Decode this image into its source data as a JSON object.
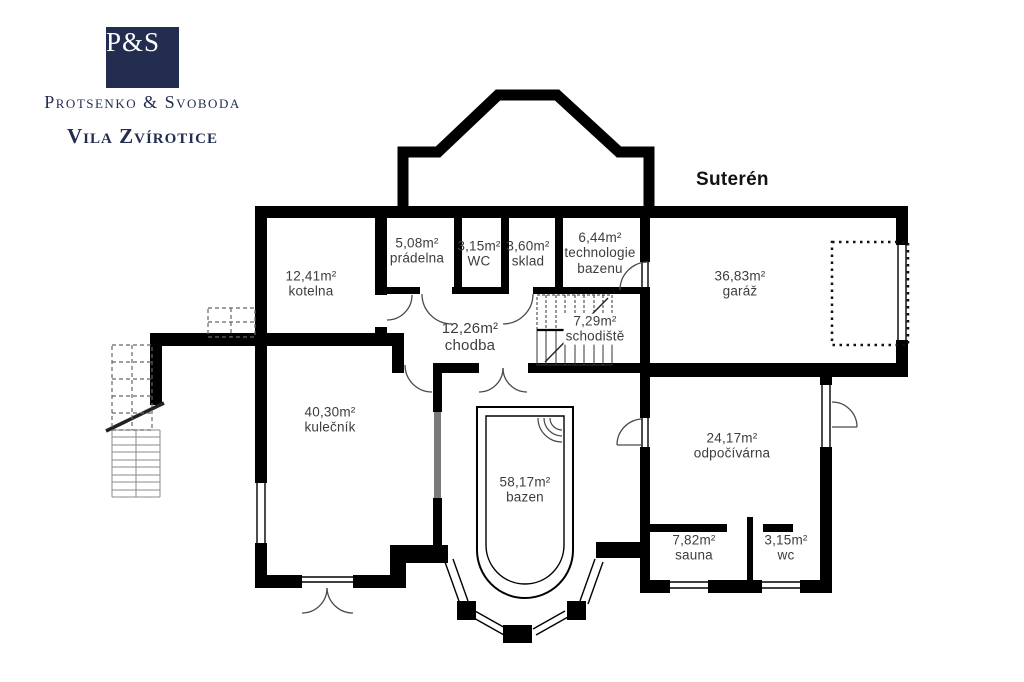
{
  "brand": {
    "monogram": "P&S",
    "company": "Protsenko & Svoboda",
    "project": "Vila Zvírotice",
    "navy": "#232d50"
  },
  "floor_title": "Suterén",
  "rooms": [
    {
      "area": "12,41m²",
      "name": "kotelna"
    },
    {
      "area": "5,08m²",
      "name": "prádelna"
    },
    {
      "area": "3,15m²",
      "name": "WC"
    },
    {
      "area": "3,60m²",
      "name": "sklad"
    },
    {
      "area": "6,44m²",
      "name": "technologie bazenu"
    },
    {
      "area": "36,83m²",
      "name": "garáž"
    },
    {
      "area": "12,26m²",
      "name": "chodba"
    },
    {
      "area": "7,29m²",
      "name": "schodiště"
    },
    {
      "area": "40,30m²",
      "name": "kulečník"
    },
    {
      "area": "58,17m²",
      "name": "bazen"
    },
    {
      "area": "24,17m²",
      "name": "odpočívárna"
    },
    {
      "area": "7,82m²",
      "name": "sauna"
    },
    {
      "area": "3,15m²",
      "name": "wc"
    }
  ],
  "colors": {
    "wall": "#000000",
    "label": "#3d3d3d",
    "glass": "#7a7a7a"
  }
}
